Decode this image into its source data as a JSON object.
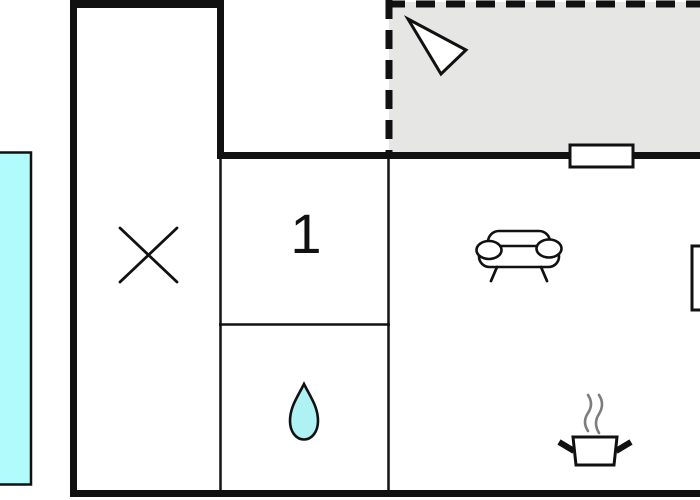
{
  "floorplan": {
    "type": "holiday-home-floor-plan",
    "room_label": "1",
    "colors": {
      "wall": "#111111",
      "background": "#ffffff",
      "terrace_fill": "#e6e6e4",
      "pool_fill": "#b2fbfd",
      "drop_fill": "#aff2f4",
      "steam": "#7d7d7d"
    },
    "areas": [
      {
        "name": "terrace",
        "style": "dashed-outline-gray"
      },
      {
        "name": "pool",
        "style": "cyan-cutoff-left"
      },
      {
        "name": "stair-room",
        "symbol": "cross"
      },
      {
        "name": "room-1",
        "label": "1"
      },
      {
        "name": "bathroom",
        "symbol": "water-drop"
      },
      {
        "name": "living-kitchen",
        "symbols": [
          "sofa",
          "cooking-pot",
          "window",
          "furniture"
        ]
      }
    ],
    "icons": [
      {
        "name": "entrance-arrow-icon"
      },
      {
        "name": "cross-icon"
      },
      {
        "name": "water-drop-icon"
      },
      {
        "name": "sofa-icon"
      },
      {
        "name": "cooking-pot-icon"
      },
      {
        "name": "window-symbol"
      }
    ]
  }
}
